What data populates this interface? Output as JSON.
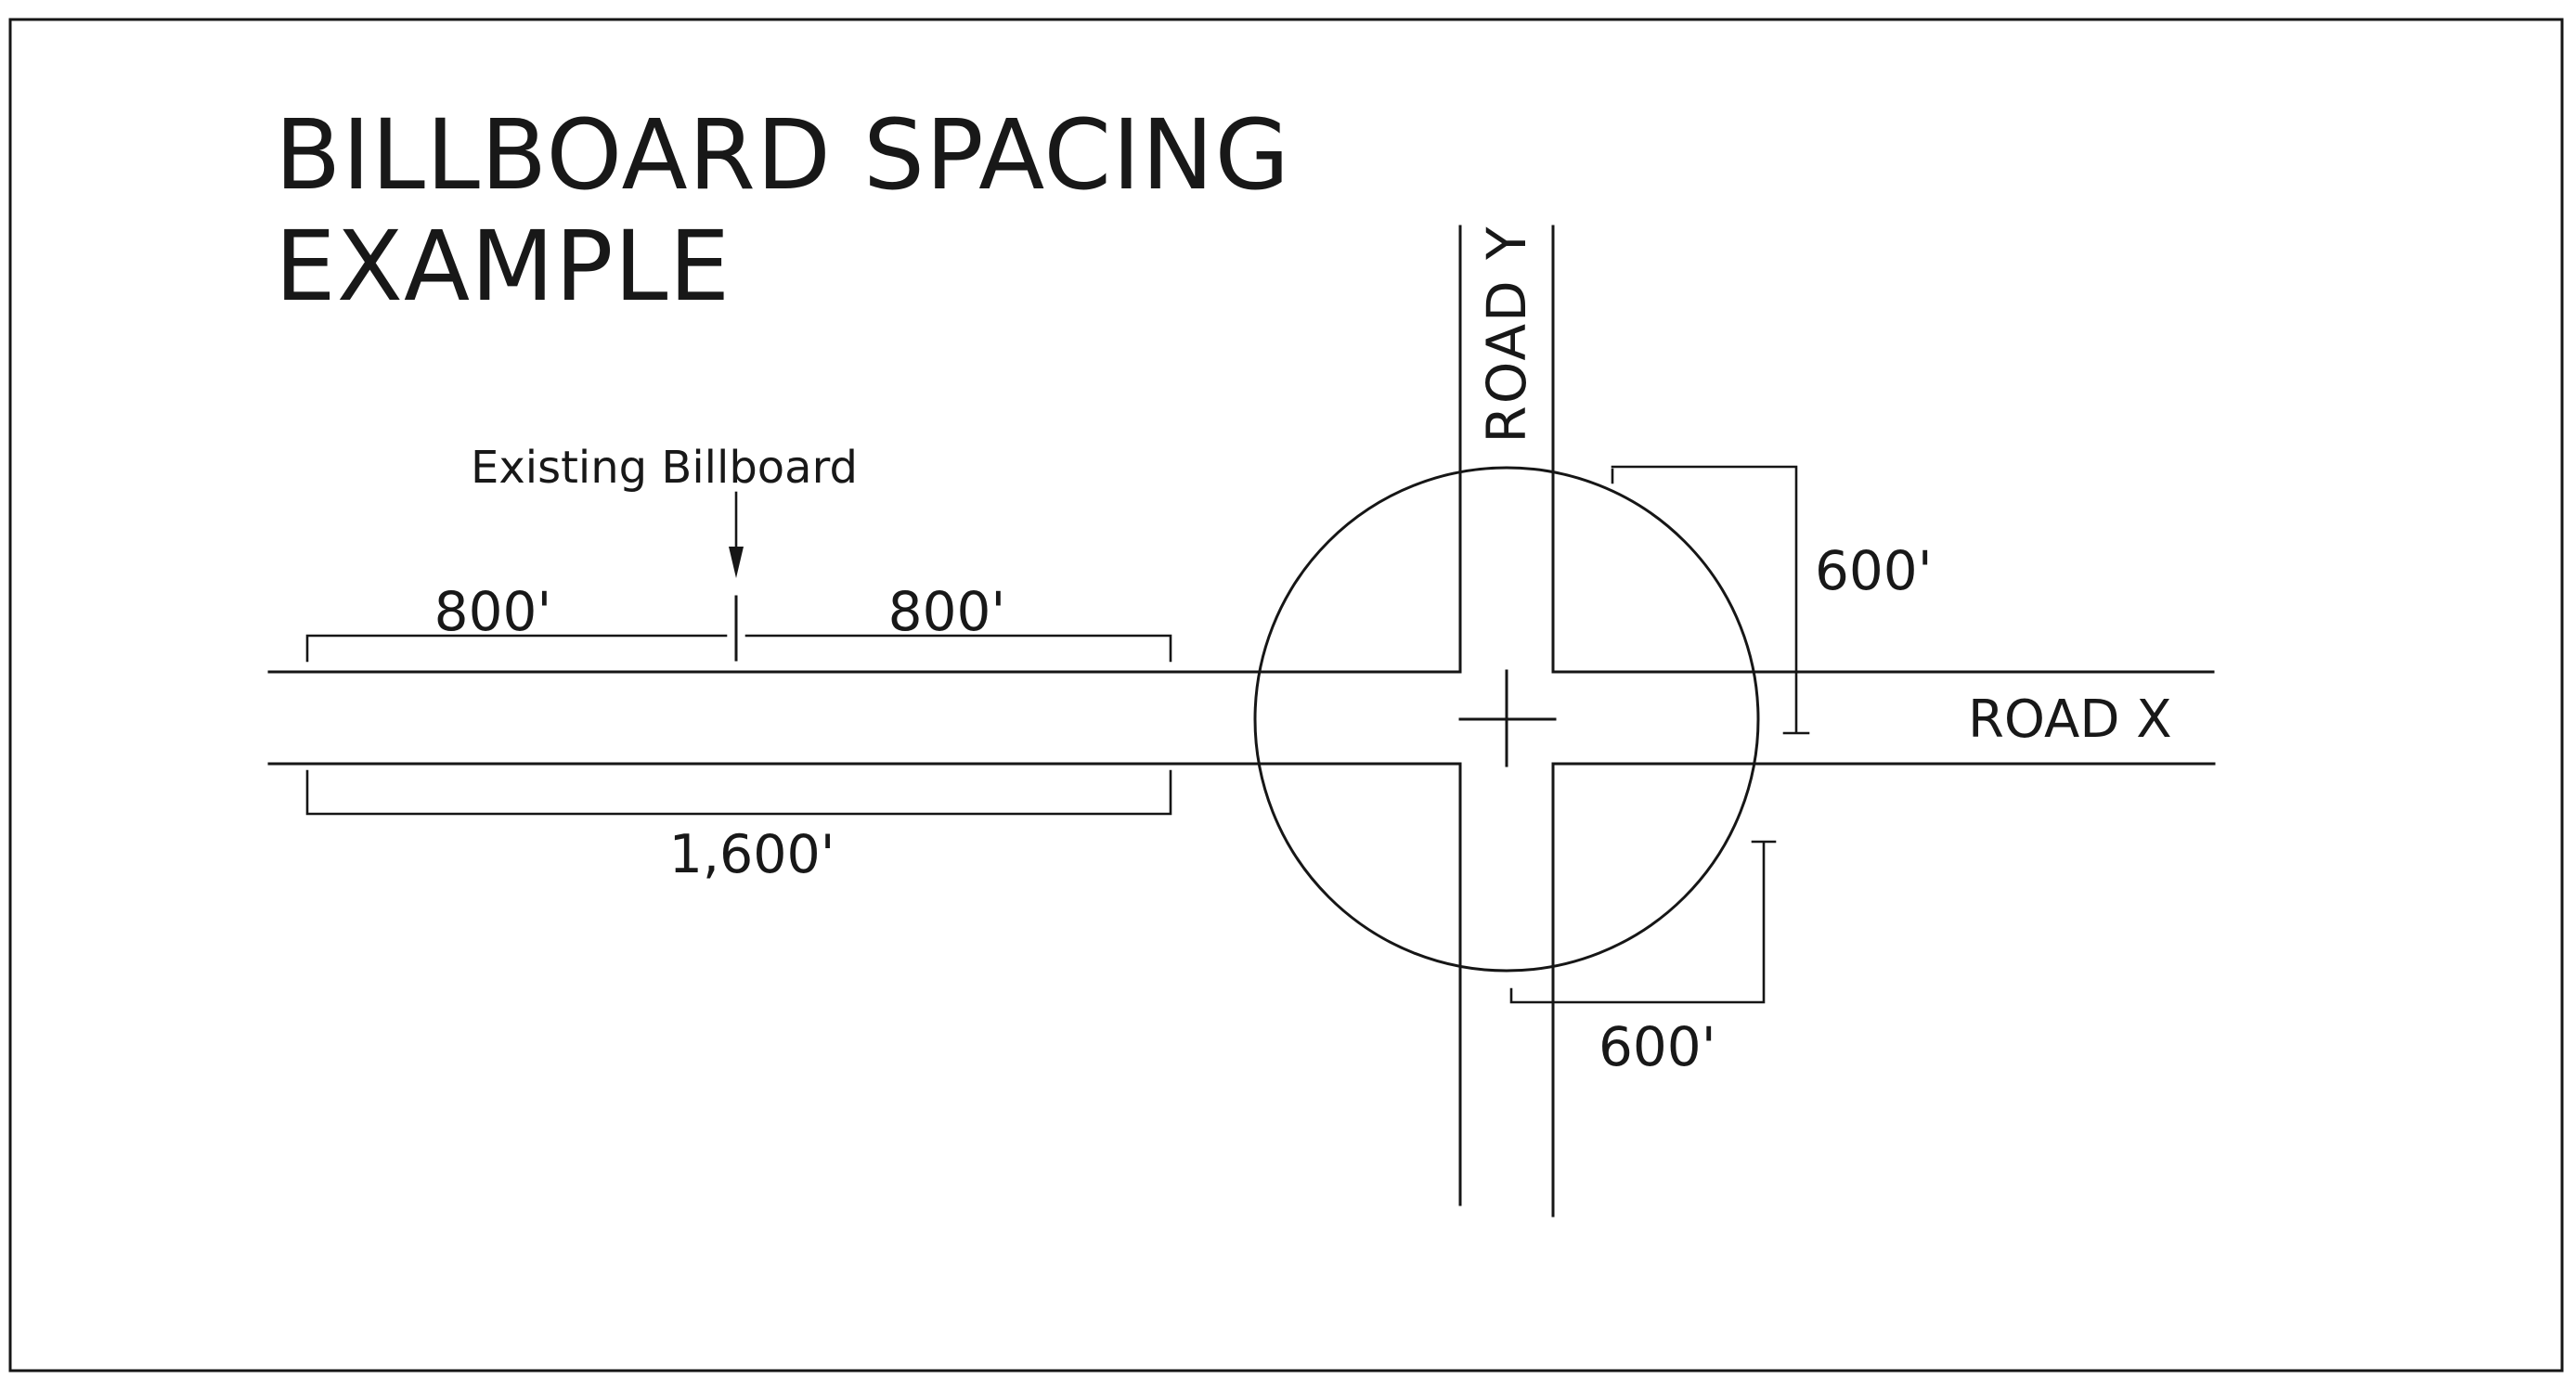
{
  "page": {
    "background_color": "#ffffff",
    "ink_color": "#161616"
  },
  "title": {
    "line1": "BILLBOARD SPACING",
    "line2": "EXAMPLE"
  },
  "labels": {
    "existing_billboard": "Existing Billboard",
    "dim_left_segment": "800'",
    "dim_right_segment": "800'",
    "dim_total": "1,600'",
    "radius_upper": "600'",
    "radius_lower": "600'"
  },
  "roads": {
    "horizontal": "ROAD X",
    "vertical": "ROAD Y"
  },
  "icons": {
    "existing_billboard_pointer": "down-arrow"
  }
}
